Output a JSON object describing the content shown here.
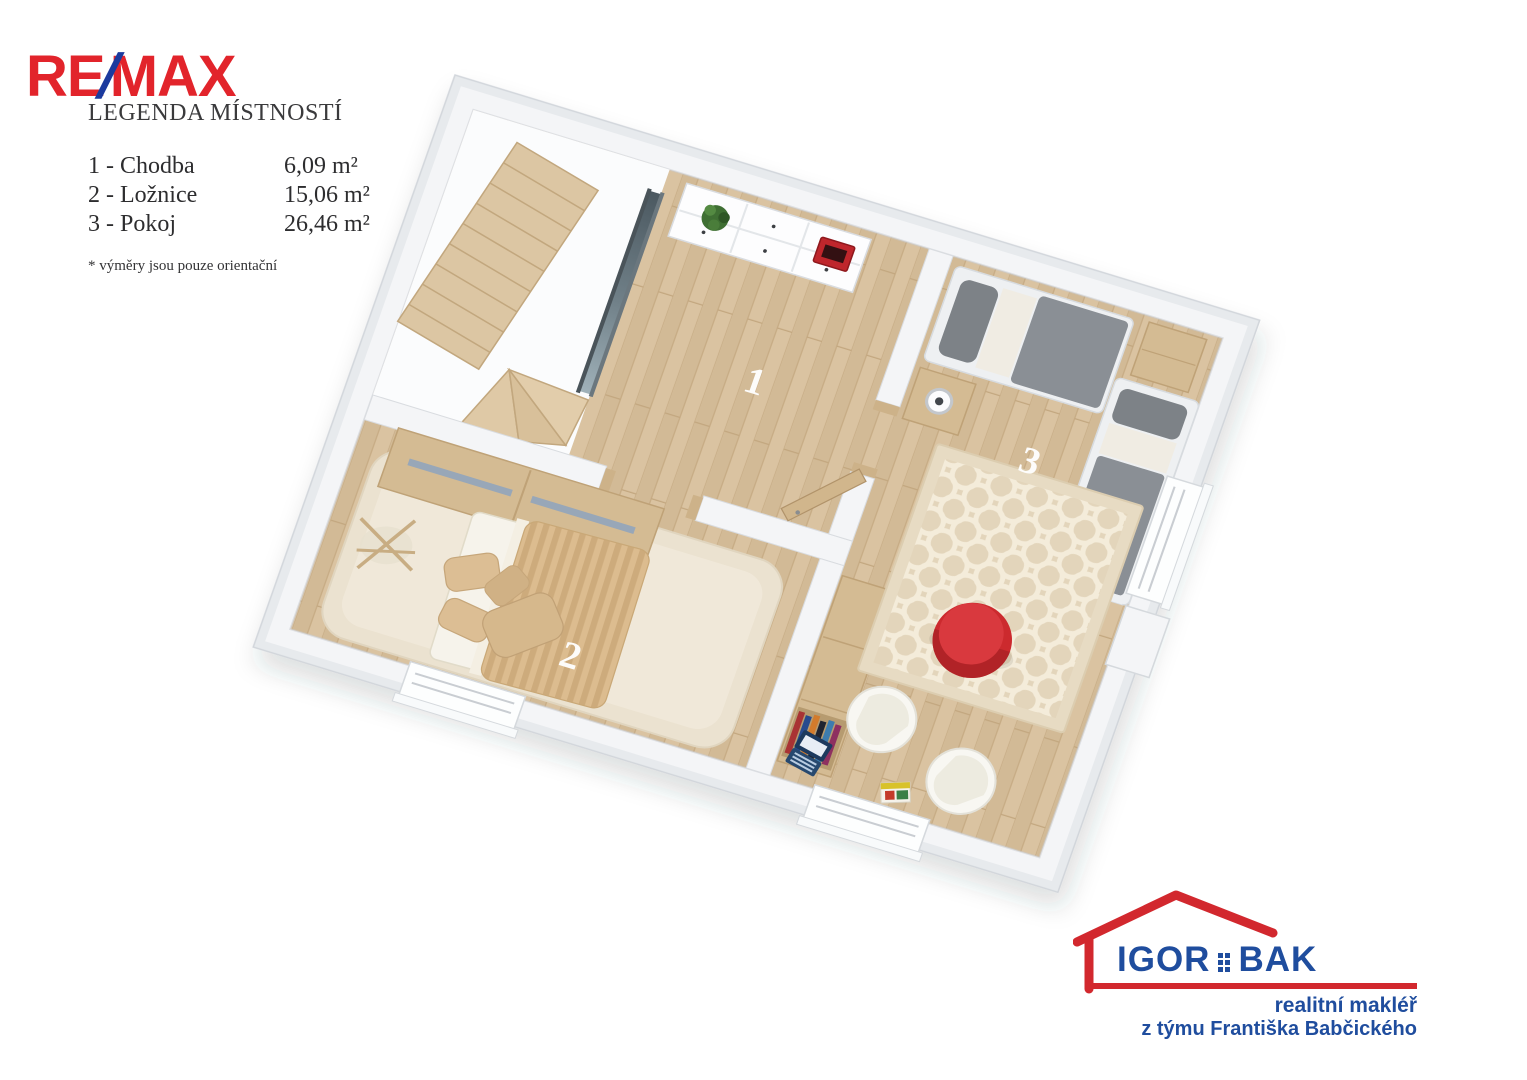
{
  "branding": {
    "remax": {
      "part1": "RE",
      "slash": "/",
      "part2": "MAX",
      "red": "#e2242b",
      "blue": "#1b3a9e"
    },
    "agent": {
      "name_left": "IGOR",
      "name_right": "BAK",
      "line1": "realitní makléř",
      "line2": "z týmu Františka Babčického",
      "blue": "#1f4d9e",
      "red": "#d2282e"
    }
  },
  "legend": {
    "title": "LEGENDA MÍSTNOSTÍ",
    "rooms": [
      {
        "num": "1",
        "name": "1 - Chodba",
        "area": "6,09 m²"
      },
      {
        "num": "2",
        "name": "2 - Ložnice",
        "area": "15,06  m²"
      },
      {
        "num": "3",
        "name": "3 - Pokoj",
        "area": "26,46 m²"
      }
    ],
    "note": "* výměry jsou pouze orientační"
  },
  "floorplan": {
    "room_labels": {
      "room1": "1",
      "room2": "2",
      "room3": "3"
    },
    "colors": {
      "floor_wood": "#d9c2a0",
      "wall": "#f4f5f7",
      "glass": "#3a4a52",
      "furniture_wood": "#d4bb93",
      "bed_gray": "#8a8f95",
      "duvet_tan": "#dcbc8f",
      "rug_cream": "#e7dbc3",
      "shag_rug": "#ebe2d0",
      "red_accent": "#cc2a2e"
    }
  }
}
